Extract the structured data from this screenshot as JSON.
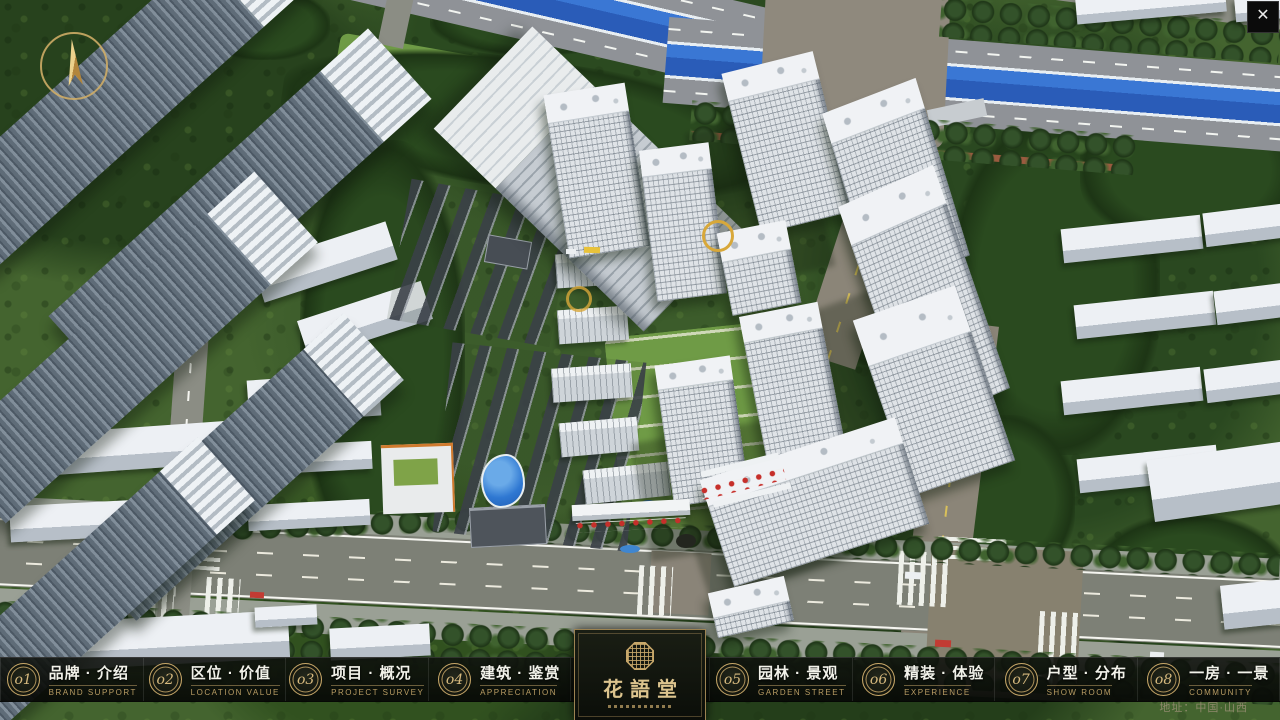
{
  "app": {
    "close_label": "✕"
  },
  "nav": {
    "items": [
      {
        "num": "o1",
        "zh": "品牌 · 介绍",
        "en": "BRAND SUPPORT"
      },
      {
        "num": "o2",
        "zh": "区位 · 价值",
        "en": "LOCATION VALUE"
      },
      {
        "num": "o3",
        "zh": "项目 · 概况",
        "en": "PROJECT SURVEY"
      },
      {
        "num": "o4",
        "zh": "建筑 · 鉴赏",
        "en": "APPRECIATION"
      },
      {
        "num": "o5",
        "zh": "园林 · 景观",
        "en": "GARDEN STREET"
      },
      {
        "num": "o6",
        "zh": "精装 · 体验",
        "en": "EXPERIENCE"
      },
      {
        "num": "o7",
        "zh": "户型 · 分布",
        "en": "SHOW ROOM"
      },
      {
        "num": "o8",
        "zh": "一房 · 一景",
        "en": "COMMUNITY"
      }
    ]
  },
  "logo": {
    "title": "花語堂"
  },
  "footer": {
    "address": "地址：中国·山西"
  },
  "colors": {
    "gold": "#c9a96a",
    "bar_bg": "#0d100b",
    "river": "#2f6fd0",
    "text_white": "#f2f2ea"
  }
}
